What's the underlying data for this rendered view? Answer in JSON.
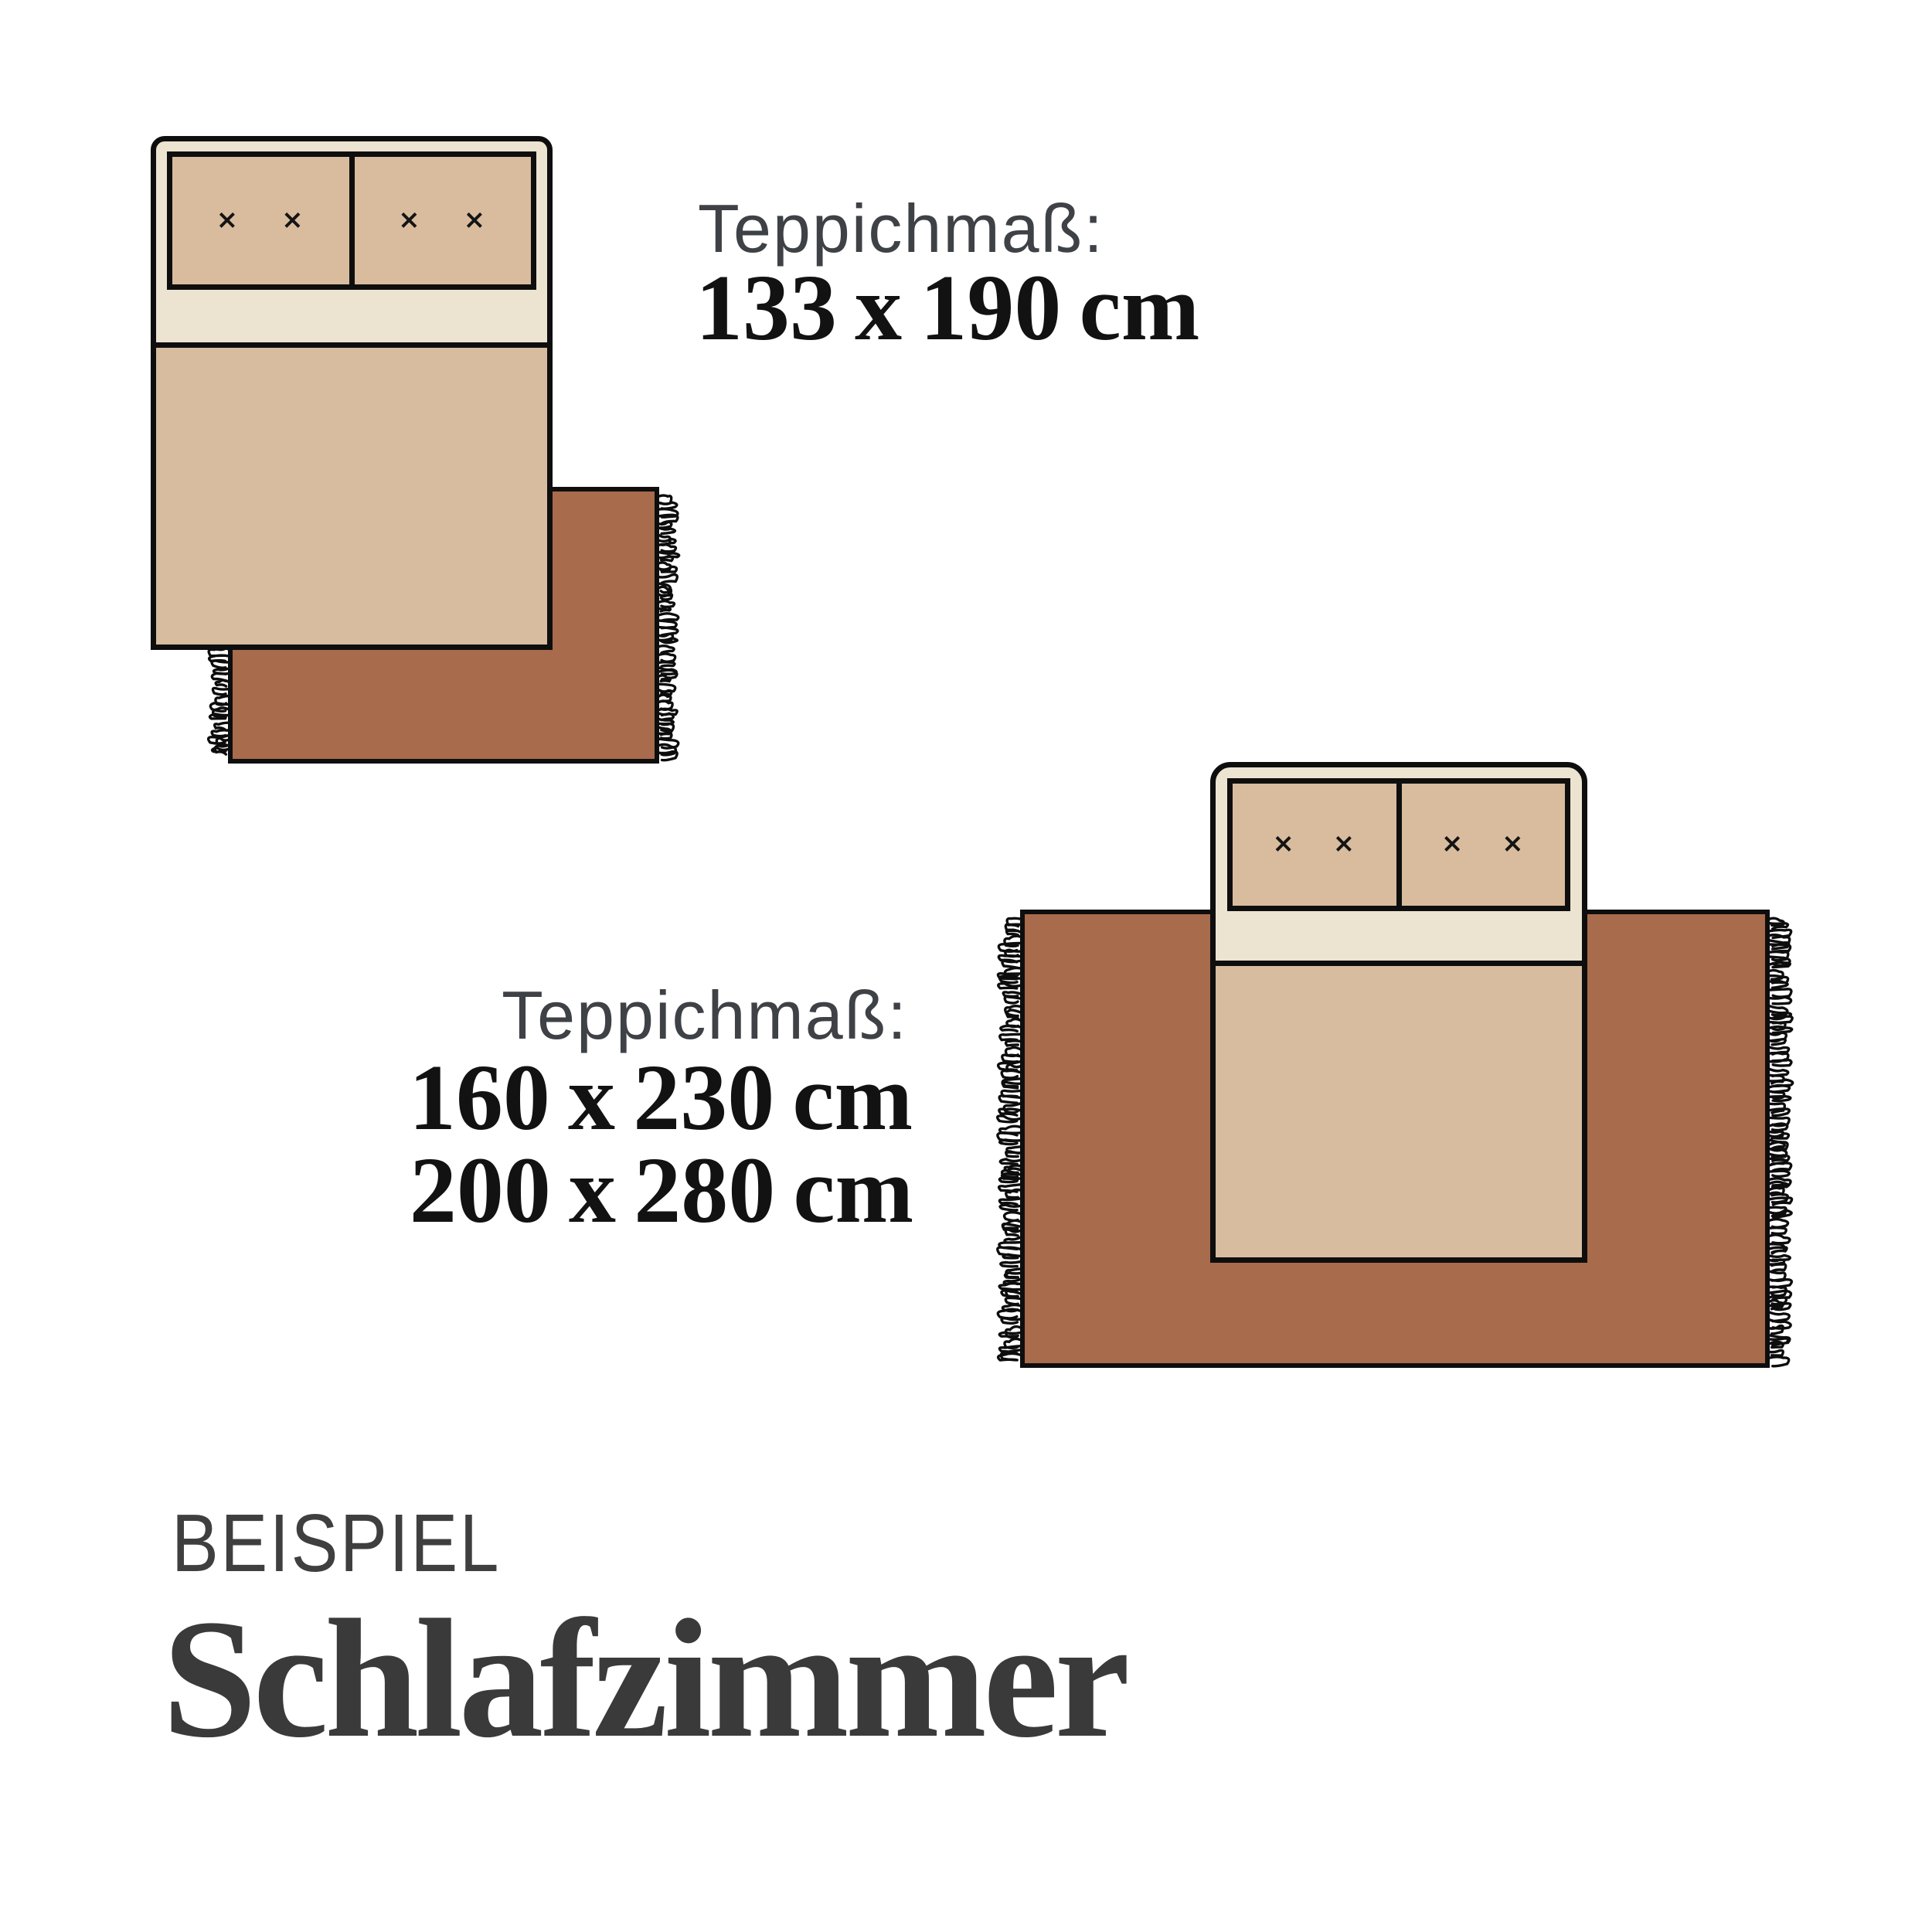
{
  "colors": {
    "background": "#ffffff",
    "rug_brown": "#a86b4c",
    "bed_frame_cream": "#ece3d1",
    "pillow_tan": "#d9bc9e",
    "duvet_tan": "#d8bca0",
    "outline_black": "#0e0e0e",
    "label_gray": "#3e4145",
    "size_text_black": "#121212",
    "eyebrow_gray": "#3f3f3f",
    "heading_charcoal": "#3a3a3a"
  },
  "example_small": {
    "label": "Teppichmaß:",
    "size": "133 x 190 cm"
  },
  "example_large": {
    "label": "Teppichmaß:",
    "sizes": [
      "160 x 230 cm",
      "200 x 280 cm"
    ]
  },
  "footer": {
    "eyebrow": "BEISPIEL",
    "heading": "Schlafzimmer"
  },
  "bed": {
    "pillow_mark": "×"
  }
}
